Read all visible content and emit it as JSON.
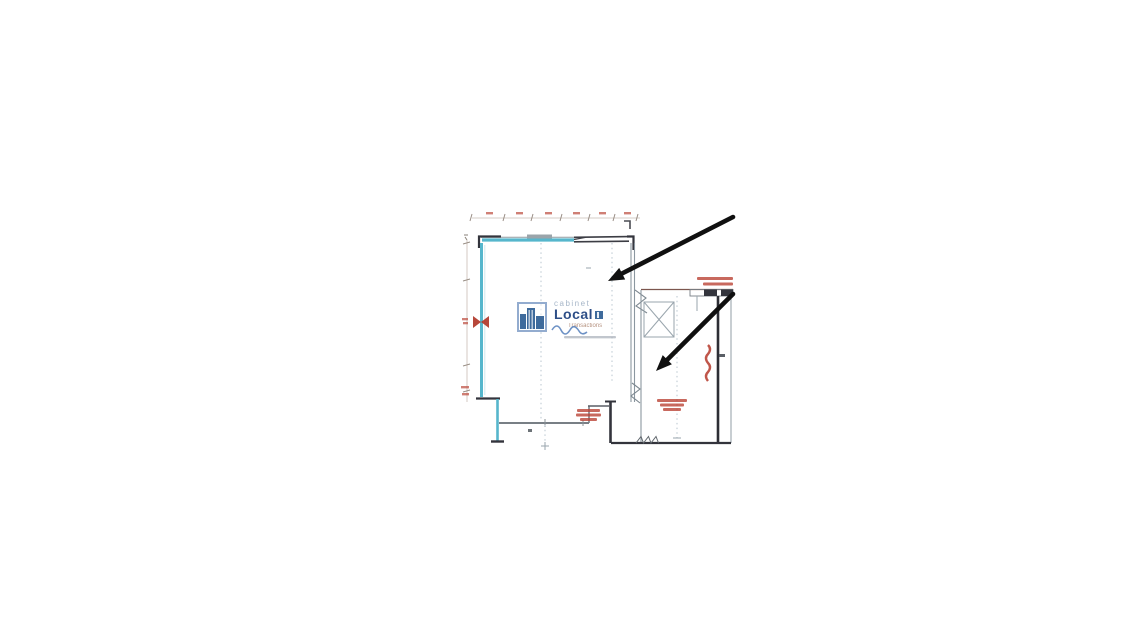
{
  "page": {
    "kind": "scanned floor plan with annotation arrows",
    "background_color": "#ffffff"
  },
  "watermark": {
    "line1": "cabinet",
    "line2": "Local",
    "line3": "Transactions",
    "icon": "blue-buildings-logo",
    "colors": {
      "frame": "#8aa6cc",
      "buildings": "#2f5f94",
      "local_text": "#1c3f7d",
      "cabinet_text": "#9fb0c4",
      "transactions_text": "#b08a76"
    }
  },
  "drawing": {
    "wall_color_teal": "#56b6cc",
    "wall_color_dark": "#33343c",
    "grid_color": "#b9c6cf",
    "dimension_color": "#c9bdb4",
    "annotation_red": "#b5382a",
    "annotations_note": "red dimension figures and notes are illegible scan marks"
  },
  "arrows": [
    {
      "name": "arrow-1",
      "from_x": 733,
      "from_y": 217,
      "tip_x": 608,
      "tip_y": 281,
      "color": "#101010"
    },
    {
      "name": "arrow-2",
      "from_x": 733,
      "from_y": 294,
      "tip_x": 656,
      "tip_y": 371,
      "color": "#101010"
    }
  ]
}
